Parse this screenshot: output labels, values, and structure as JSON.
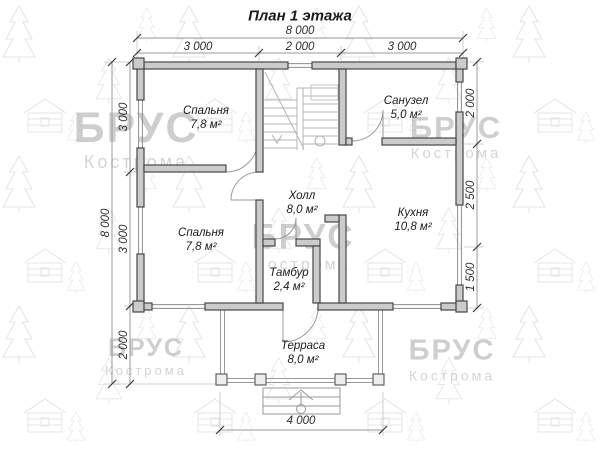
{
  "title": "План 1 этажа",
  "watermark": {
    "brand": "БРУС",
    "city": "Кострома"
  },
  "dimensions": {
    "top_total": "8 000",
    "top_segments": [
      "3 000",
      "2 000",
      "3 000"
    ],
    "left_total": "8 000",
    "left_segments": [
      "3 000",
      "3 000",
      "2 000"
    ],
    "right_segments": [
      "2 000",
      "2 500",
      "1 500"
    ],
    "bottom": "4 000"
  },
  "rooms": [
    {
      "name": "Спальня",
      "area": "7,8 м²"
    },
    {
      "name": "Санузел",
      "area": "5,0 м²"
    },
    {
      "name": "Холл",
      "area": "8,0 м²"
    },
    {
      "name": "Кухня",
      "area": "10,8 м²"
    },
    {
      "name": "Спальня",
      "area": "7,8 м²"
    },
    {
      "name": "Тамбур",
      "area": "2,4 м²"
    },
    {
      "name": "Терраса",
      "area": "8,0 м²"
    }
  ]
}
